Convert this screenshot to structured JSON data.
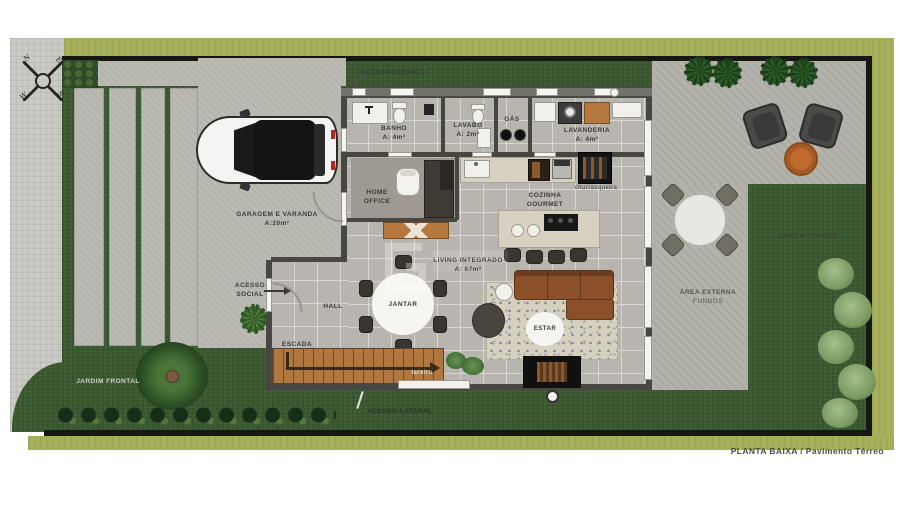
{
  "title": "PLANTA BAIXA / Pavimento Térreo",
  "compass": {
    "n": "N",
    "e": "E",
    "s": "S",
    "w": "W"
  },
  "labels": {
    "acesso_servico": "ACESSO SERVIÇO",
    "acesso_social_1": "ACESSO",
    "acesso_social_2": "SOCIAL",
    "acesso_lateral": "ACESSO LATERAL",
    "garagem_1": "GARAGEM E VARANDA",
    "garagem_2": "A:20m²",
    "banho_1": "BANHO",
    "banho_2": "A: 4m²",
    "lavabo_1": "LAVABO",
    "lavabo_2": "A: 2m²",
    "gas": "GÁS",
    "lavanderia_1": "LAVANDERIA",
    "lavanderia_2": "A: 4m²",
    "home_office_1": "HOME",
    "home_office_2": "OFFICE",
    "cozinha_1": "COZINHA",
    "cozinha_2": "GOURMET",
    "churrasqueira": "churrasqueira",
    "living_1": "LIVING INTEGRADO",
    "living_2": "A: 67m²",
    "hall": "HALL",
    "jantar": "JANTAR",
    "estar": "ESTAR",
    "escada": "ESCADA",
    "lareira": "lareira",
    "jardim_frontal": "JARDIM FRONTAL",
    "jardim_fundos": "JARDIM FUNDOS",
    "area_externa_1": "ÁREA EXTERNA",
    "area_externa_2": "FUNDOS"
  },
  "colors": {
    "lawn": "#3b5a31",
    "lawn_light": "#a7b15c",
    "concrete": "#bcbbb3",
    "tile_floor": "#b8b4ae",
    "wall": "#474641",
    "wood_deck": "#b07840",
    "sofa_brown": "#8b5029",
    "accent_orange": "#c06a2e"
  }
}
